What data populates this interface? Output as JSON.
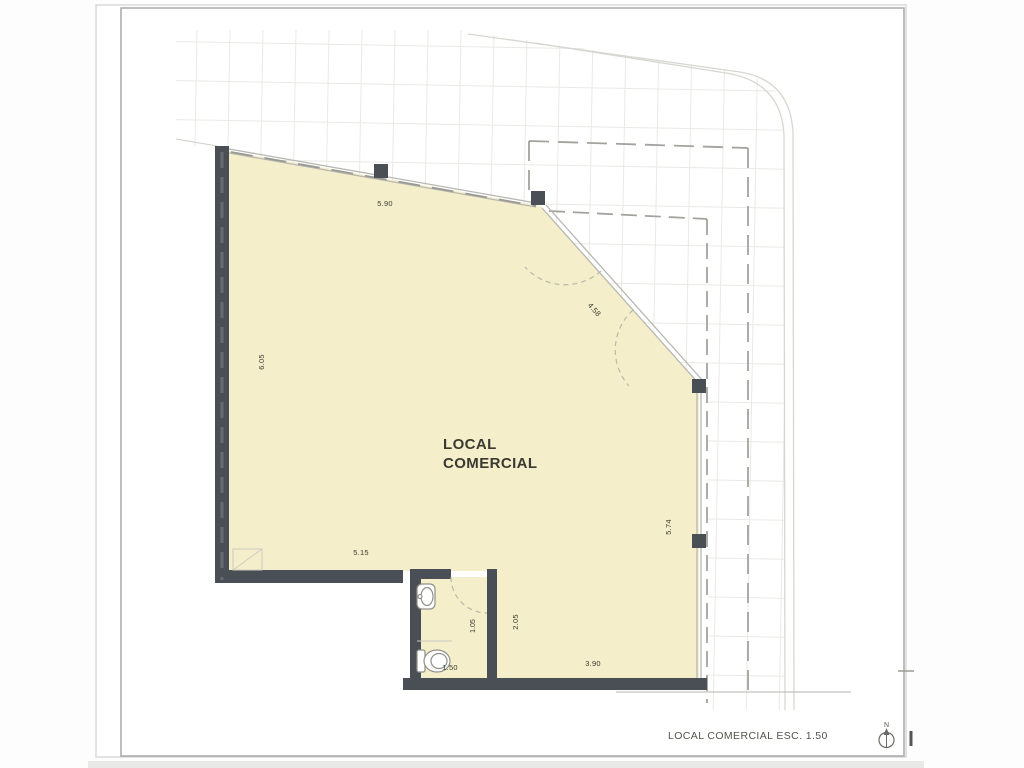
{
  "drawing": {
    "room": {
      "label_line1": "LOCAL",
      "label_line2": "COMERCIAL"
    },
    "dimensions": {
      "storefront_top": "5.90",
      "left_wall": "6.05",
      "corner_chamfer": "4.58",
      "right_side": "5.74",
      "bottom_interior": "5.15",
      "bath_partition": "1.05",
      "lower_zone_depth": "2.05",
      "bath_width": "1.50",
      "lower_zone_width": "3.90"
    },
    "titleblock": {
      "caption": "LOCAL COMERCIAL ESC. 1.50",
      "north_label": "N"
    },
    "colors": {
      "wall": "#4a4f55",
      "floor": "#f5eecb",
      "glass_line": "#b7b7b0",
      "paper": "#ffffff"
    }
  }
}
